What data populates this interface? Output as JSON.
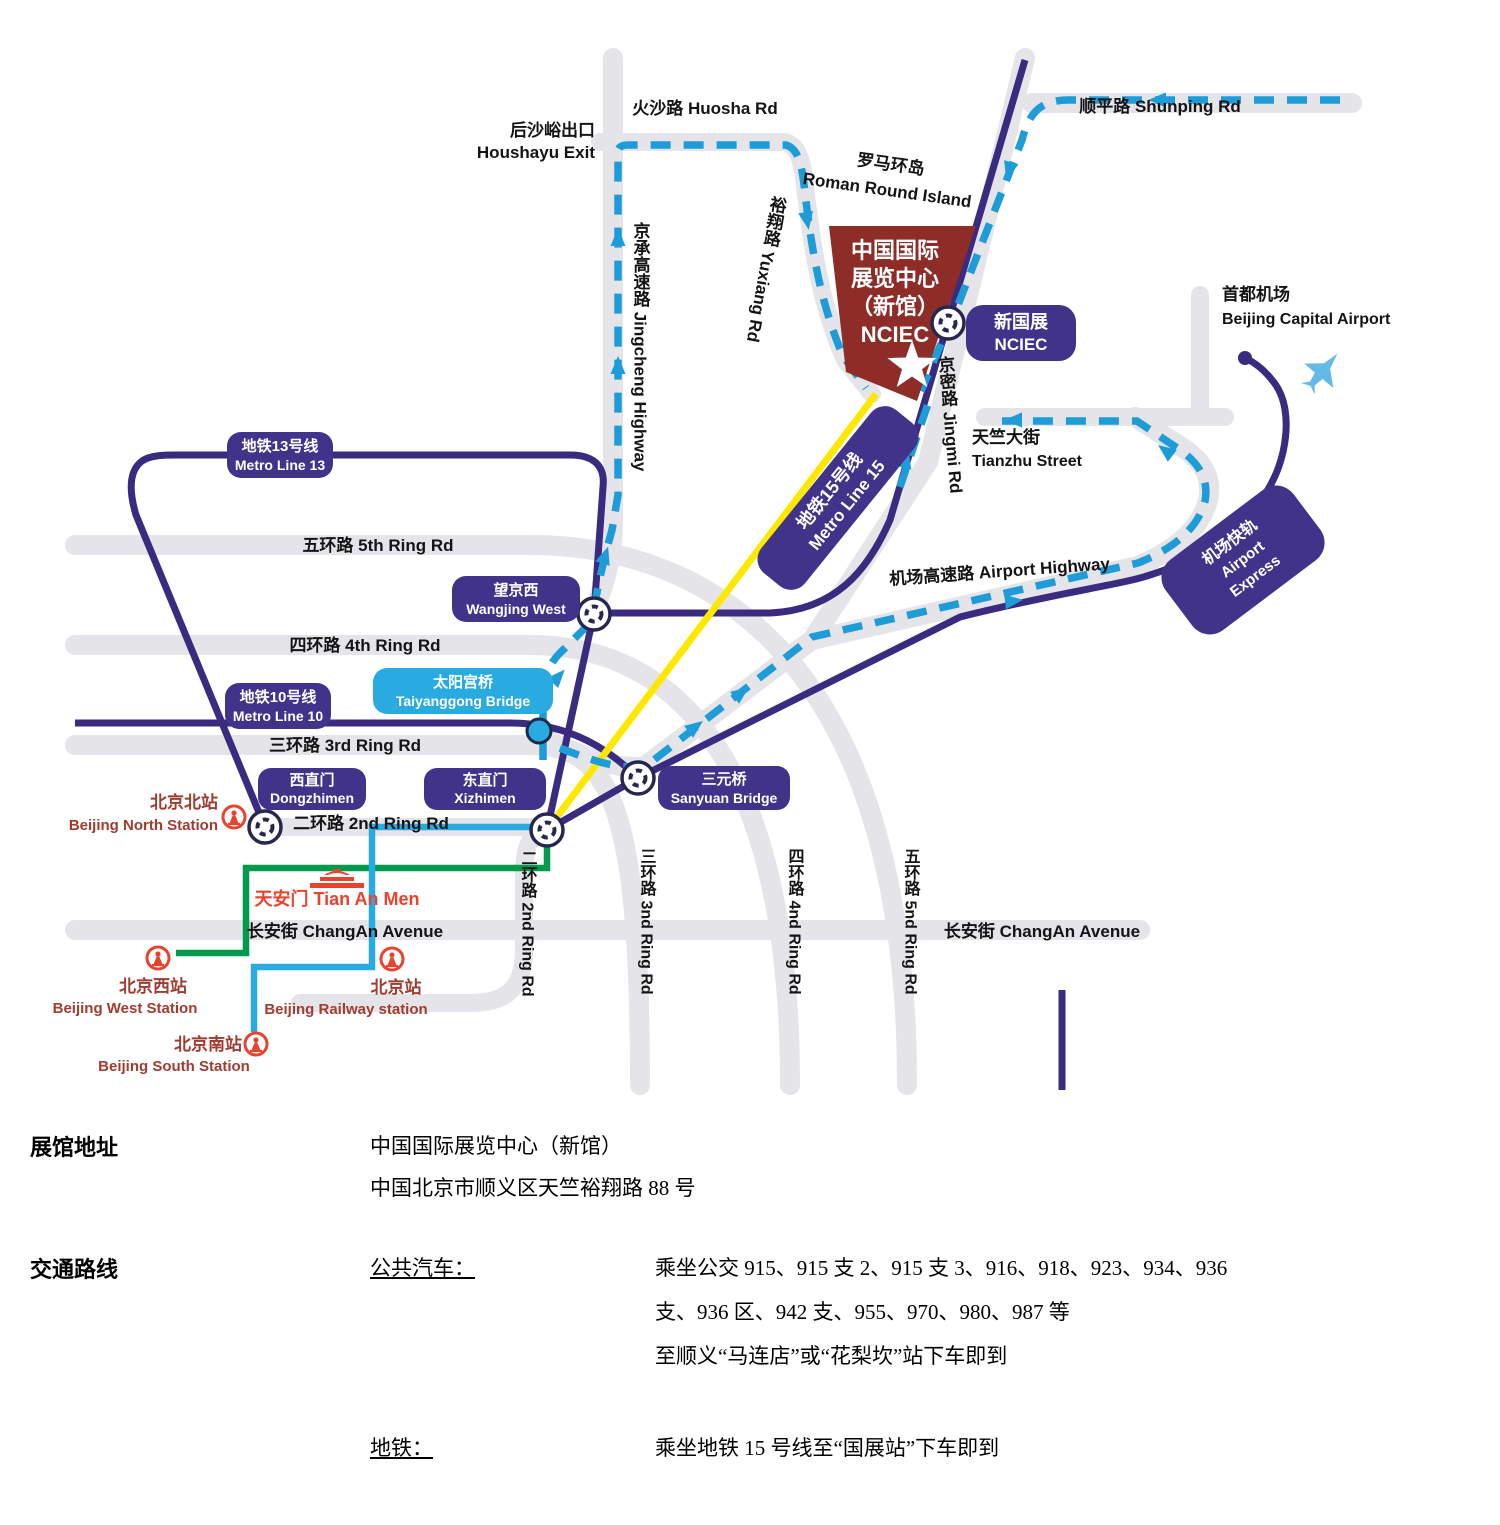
{
  "colors": {
    "metro_purple": "#3A2B80",
    "road_gray": "#E5E4E8",
    "route_dash_blue": "#1E9CD7",
    "rail_cyan": "#29ABE2",
    "rail_green": "#009A4E",
    "line15_yellow": "#FFE800",
    "building_red": "#8E2D28",
    "rail_icon_red": "#E8432E",
    "station_text": "#A03C30"
  },
  "map": {
    "labels": {
      "huosha": "火沙路 Huosha Rd",
      "houshayu_cn": "后沙峪出口",
      "houshayu_en": "Houshayu Exit",
      "shunping": "顺平路 Shunping Rd",
      "roman_cn": "罗马环岛",
      "roman_en": "Roman Round Island",
      "yuxiang": "裕翔路 Yuxiang Rd",
      "jingcheng": "京承高速路 Jingcheng Highway",
      "jingmi": "京密路 Jingmi Rd",
      "tianzhu_cn": "天竺大街",
      "tianzhu_en": "Tianzhu Street",
      "airport_hwy": "机场高速路 Airport Highway",
      "capital_cn": "首都机场",
      "capital_en": "Beijing Capital Airport",
      "ring5_h": "五环路 5th Ring Rd",
      "ring4_h": "四环路 4th Ring Rd",
      "ring3_h": "三环路 3rd Ring Rd",
      "ring2_h": "二环路 2nd Ring Rd",
      "ring2_v": "二环路 2nd Ring Rd",
      "ring3_v": "三环路 3nd Ring Rd",
      "ring4_v": "四环路 4nd Ring Rd",
      "ring5_v": "五环路 5nd Ring Rd",
      "changan_left": "长安街 ChangAn Avenue",
      "changan_right": "长安街 ChangAn Avenue",
      "tiananmen": "天安门 Tian An Men"
    },
    "badges": {
      "metro13": {
        "cn": "地铁13号线",
        "en": "Metro Line 13"
      },
      "metro10": {
        "cn": "地铁10号线",
        "en": "Metro Line 10"
      },
      "metro15": {
        "cn": "地铁15号线",
        "en": "Metro Line 15"
      },
      "wangjing": {
        "cn": "望京西",
        "en": "Wangjing West"
      },
      "taiyanggong": {
        "cn": "太阳宫桥",
        "en": "Taiyanggong Bridge"
      },
      "dongzhimen": {
        "cn": "西直门",
        "en": "Dongzhimen"
      },
      "xizhimen": {
        "cn": "东直门",
        "en": "Xizhimen"
      },
      "sanyuan": {
        "cn": "三元桥",
        "en": "Sanyuan Bridge"
      },
      "nciec": {
        "cn": "新国展",
        "en": "NCIEC"
      },
      "airport_express": {
        "cn": "机场快轨",
        "en1": "Airport",
        "en2": "Express"
      }
    },
    "building": {
      "l1": "中国国际",
      "l2": "展览中心",
      "l3": "（新馆）",
      "l4": "NCIEC"
    },
    "stations": {
      "north_cn": "北京北站",
      "north_en": "Beijing North Station",
      "west_cn": "北京西站",
      "west_en": "Beijing West Station",
      "rail_cn": "北京站",
      "rail_en": "Beijing Railway station",
      "south_cn": "北京南站",
      "south_en": "Beijing South Station"
    }
  },
  "info": {
    "address_label": "展馆地址",
    "address_line1": "中国国际展览中心（新馆）",
    "address_line2": "中国北京市顺义区天竺裕翔路 88 号",
    "transport_label": "交通路线",
    "bus_label": "公共汽车：",
    "bus_line1": "乘坐公交 915、915 支 2、915 支 3、916、918、923、934、936",
    "bus_line2": "支、936 区、942 支、955、970、980、987 等",
    "bus_line3": "至顺义“马连店”或“花梨坎”站下车即到",
    "metro_label": "地铁：",
    "metro_line1": "乘坐地铁 15 号线至“国展站”下车即到"
  }
}
